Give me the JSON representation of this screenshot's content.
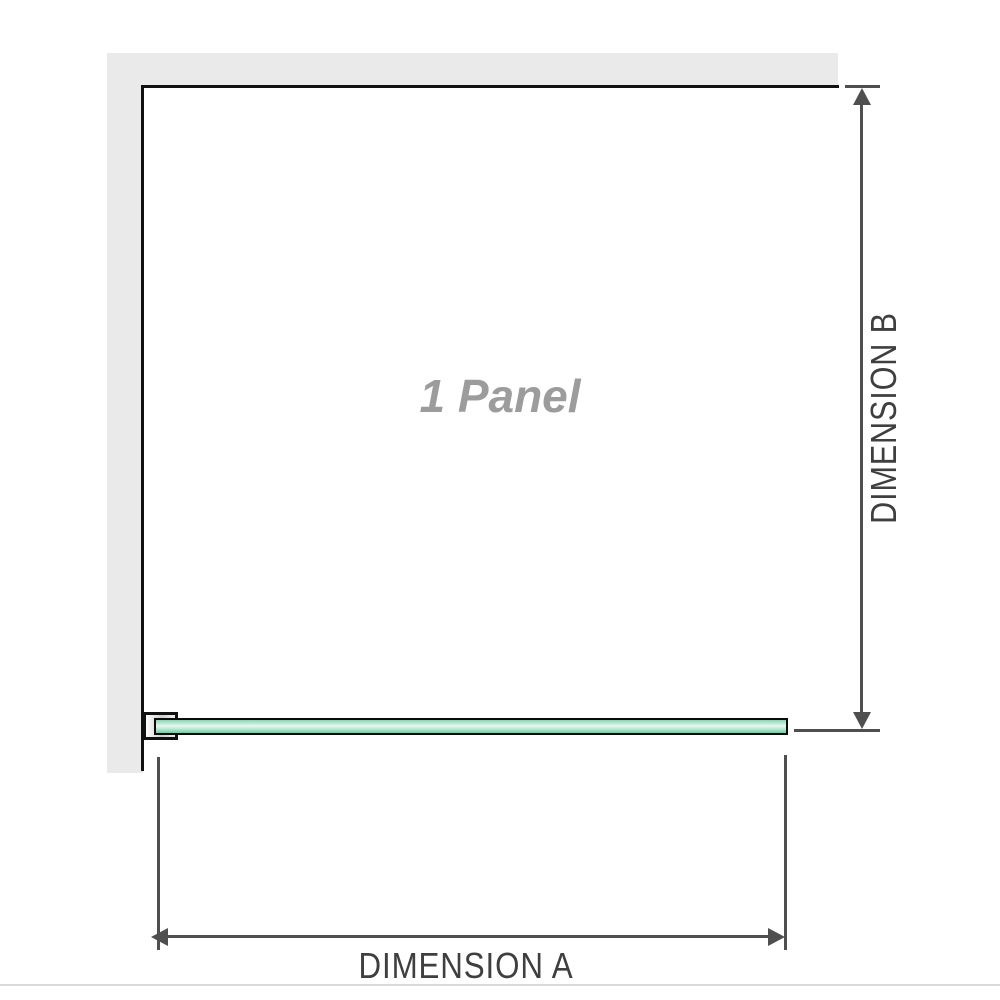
{
  "diagram": {
    "title": "1 Panel shower screen dimension diagram",
    "panel_label": "1 Panel",
    "dimension_a_label": "DIMENSION A",
    "dimension_b_label": "DIMENSION B"
  },
  "colors": {
    "wall": "#eaeaea",
    "frame": "#111111",
    "dimension": "#4f4f4f",
    "label-text": "#3f3f3f",
    "panel-label-text": "#9c9c9c",
    "glass-border": "#0c0c0c",
    "glass-green-light": "#e7f7ef",
    "glass-green": "#9fdcbf",
    "divider": "#d9d9d9"
  }
}
